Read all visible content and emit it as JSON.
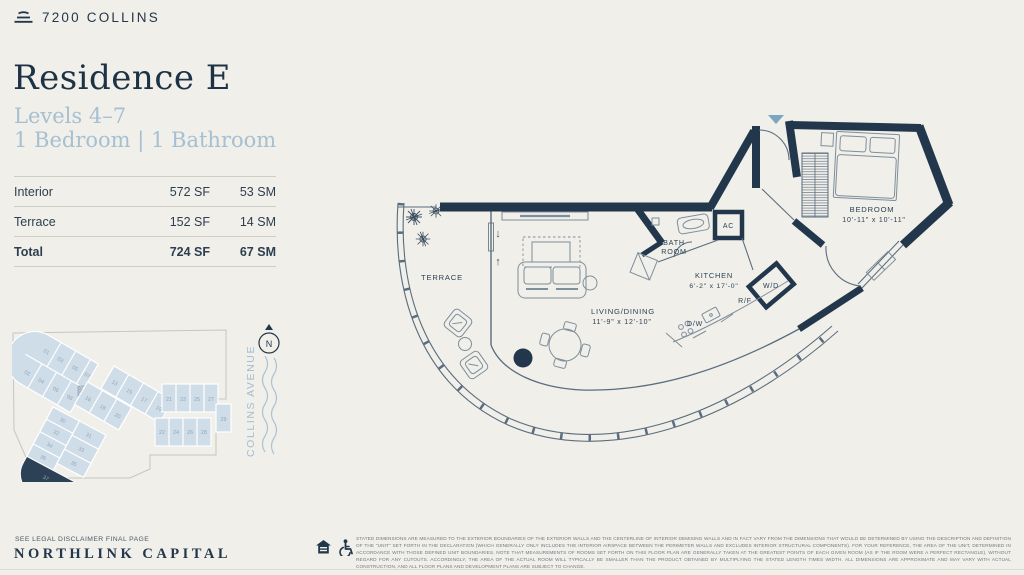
{
  "brand": {
    "name": "7200 COLLINS"
  },
  "residence": {
    "title": "Residence E",
    "levels": "Levels 4–7",
    "config": "1 Bedroom | 1 Bathroom"
  },
  "area_table": {
    "rows": [
      {
        "label": "Interior",
        "sf": "572 SF",
        "sm": "53 SM"
      },
      {
        "label": "Terrace",
        "sf": "152 SF",
        "sm": "14 SM"
      },
      {
        "label": "Total",
        "sf": "724 SF",
        "sm": "67 SM"
      }
    ]
  },
  "floor_plan": {
    "terrace": "TERRACE",
    "living": "LIVING/DINING",
    "living_dims": "11'-9\" x 12'-10\"",
    "bath_line1": "BATH",
    "bath_line2": "ROOM",
    "ac": "AC",
    "kitchen": "KITCHEN",
    "kitchen_dims": "6'-2\" x 17'-0\"",
    "wd": "W/D",
    "rf": "R/F",
    "dw": "D/W",
    "bedroom": "BEDROOM",
    "bedroom_dims": "10'-11\" x 10'-11\"",
    "arrow_down": "↓",
    "arrow_up": "↑"
  },
  "keyplan": {
    "units": [
      "01",
      "03",
      "05",
      "07",
      "02",
      "04",
      "06",
      "08",
      "13",
      "15",
      "17",
      "19",
      "16",
      "18",
      "20",
      "21",
      "23",
      "25",
      "27",
      "29",
      "22",
      "24",
      "26",
      "28",
      "30",
      "32",
      "34",
      "36",
      "31",
      "33",
      "35",
      "37"
    ],
    "highlighted_unit": "37",
    "street": "COLLINS AVENUE",
    "compass": "N"
  },
  "footer": {
    "disclaimer_note": "SEE LEGAL DISCLAIMER FINAL PAGE",
    "company": "NORTHLINK CAPITAL",
    "legal": "STATED DIMENSIONS ARE MEASURED TO THE EXTERIOR BOUNDARIES OF THE EXTERIOR WALLS AND THE CENTERLINE OF INTERIOR DEMISING WALLS AND IN FACT VARY FROM THE DIMENSIONS THAT WOULD BE DETERMINED BY USING THE DESCRIPTION AND DEFINITION OF THE \"UNIT\" SET FORTH IN THE DECLARATION (WHICH GENERALLY ONLY INCLUDES THE INTERIOR AIRSPACE BETWEEN THE PERIMETER WALLS AND EXCLUDES INTERIOR STRUCTURAL COMPONENTS).  FOR YOUR REFERENCE, THE AREA OF THE UNIT, DETERMINED IN ACCORDANCE WITH THOSE DEFINED UNIT BOUNDARIES.  NOTE THAT MEASUREMENTS OF ROOMS SET FORTH ON THIS FLOOR PLAN ARE GENERALLY TAKEN AT THE GREATEST POINTS OF EACH GIVEN ROOM (AS IF THE ROOM WERE A PERFECT RECTANGLE), WITHOUT REGARD FOR ANY CUTOUTS.  ACCORDINGLY, THE AREA OF THE ACTUAL ROOM WILL TYPICALLY BE SMALLER THAN THE PRODUCT OBTAINED BY MULTIPLYING THE STATED LENGTH TIMES WIDTH.  ALL DIMENSIONS ARE APPROXIMATE AND MAY VARY WITH ACTUAL CONSTRUCTION, AND ALL FLOOR PLANS AND DEVELOPMENT PLANS ARE SUBJECT TO CHANGE."
  },
  "colors": {
    "navy": "#22374b",
    "light_blue": "#a6bfd1",
    "keyplan_fill": "#cfdde9",
    "accent_triangle": "#7ba6c2"
  }
}
